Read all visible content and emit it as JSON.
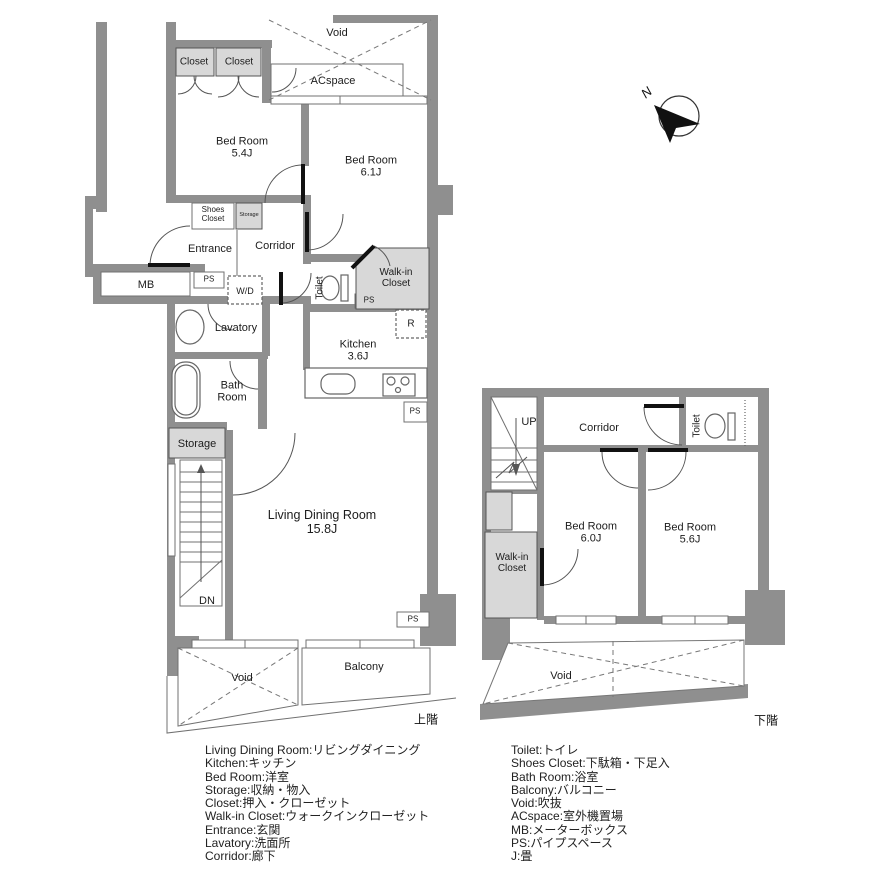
{
  "colors": {
    "wall": "#8f8f8f",
    "closet_fill": "#d8d8d8",
    "thin_line": "#707070",
    "door_leaf": "#111111",
    "text": "#1c1c1c"
  },
  "upper_floor": {
    "caption": "上階",
    "rooms": {
      "closet_left": "Closet",
      "closet_right": "Closet",
      "void_top": "Void",
      "acspace": "ACspace",
      "bedroom_a": "Bed Room\n5.4J",
      "bedroom_b": "Bed Room\n6.1J",
      "shoes_closet": "Shoes\nCloset",
      "storage_mini": "Storage",
      "entrance": "Entrance",
      "corridor": "Corridor",
      "mb": "MB",
      "ps1": "PS",
      "wd": "W/D",
      "toilet": "Toilet",
      "walkin": "Walk-in\nCloset",
      "ps2": "PS",
      "lavatory": "Lavatory",
      "kitchen": "Kitchen\n3.6J",
      "fridge": "R",
      "bathroom": "Bath\nRoom",
      "ps3": "PS",
      "storage": "Storage",
      "living": "Living Dining Room\n15.8J",
      "stairs_dn": "DN",
      "ps4": "PS",
      "void_bottom": "Void",
      "balcony": "Balcony"
    }
  },
  "lower_floor": {
    "caption": "下階",
    "rooms": {
      "stairs_up": "UP",
      "corridor": "Corridor",
      "toilet": "Toilet",
      "bedroom_c": "Bed Room\n6.0J",
      "bedroom_d": "Bed Room\n5.6J",
      "walkin": "Walk-in\nCloset",
      "void": "Void"
    }
  },
  "compass": {
    "north": "N"
  },
  "legend": {
    "left": [
      "Living Dining Room:リビングダイニング",
      "Kitchen:キッチン",
      "Bed Room:洋室",
      "Storage:収納・物入",
      "Closet:押入・クローゼット",
      "Walk-in Closet:ウォークインクローゼット",
      "Entrance:玄関",
      "Lavatory:洗面所",
      "Corridor:廊下"
    ],
    "right": [
      "Toilet:トイレ",
      "Shoes Closet:下駄箱・下足入",
      "Bath Room:浴室",
      "Balcony:バルコニー",
      "Void:吹抜",
      "ACspace:室外機置場",
      "MB:メーターボックス",
      "PS:パイプスペース",
      "J:畳"
    ]
  }
}
